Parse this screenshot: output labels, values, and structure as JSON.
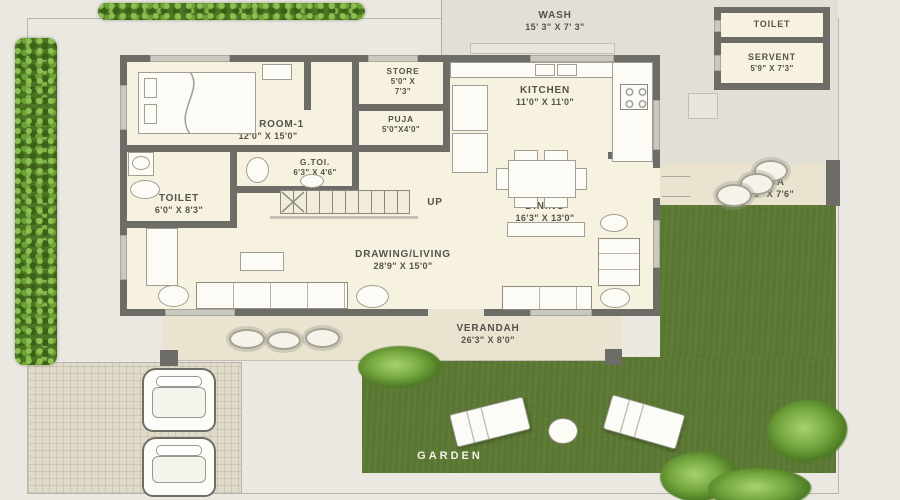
{
  "plan_title": "House ground floor plan with garden, parking and verandah",
  "rooms": {
    "wash": {
      "label": "WASH",
      "dim": "15' 3\" X 7' 3\""
    },
    "kitchen": {
      "label": "KITCHEN",
      "dim": "11'0\" X 11'0\""
    },
    "store": {
      "label": "STORE",
      "dim1": "5'0\" X",
      "dim2": "7'3\""
    },
    "puja": {
      "label": "PUJA",
      "dim": "5'0\"X4'0\""
    },
    "bedroom1": {
      "label": "BED ROOM-1",
      "dim": "12'0\" X 15'0\""
    },
    "gtoilet": {
      "label": "G.TOI.",
      "dim": "6'3\" X 4'6\""
    },
    "toilet1": {
      "label": "TOILET",
      "dim": "6'0\" X 8'3\""
    },
    "dining": {
      "label": "DINING",
      "dim": "16'3\" X 13'0\""
    },
    "living": {
      "label": "DRAWING/LIVING",
      "dim": "28'9\" X 15'0\""
    },
    "verandah": {
      "label": "VERANDAH",
      "dim": "26'3\" X 8'0\""
    },
    "otta": {
      "label": "OTTA",
      "dim": "9'6\" X 7'6\""
    },
    "toilet_out": {
      "label": "TOILET"
    },
    "servant": {
      "label": "SERVENT",
      "dim": "5'9\" X 7'3\""
    },
    "garden": {
      "label": "GARDEN"
    },
    "stairs": {
      "label": "UP"
    }
  },
  "colors": {
    "background": "#ebe8e2",
    "wall": "#6e6c66",
    "room_floor": "#f6f2df",
    "compound_gray": "#e2dfd7",
    "verandah_tan": "#e9e3d0",
    "garden_green": "#5b7833",
    "hedge_green": "#4c7424",
    "label_text": "#55534c"
  }
}
